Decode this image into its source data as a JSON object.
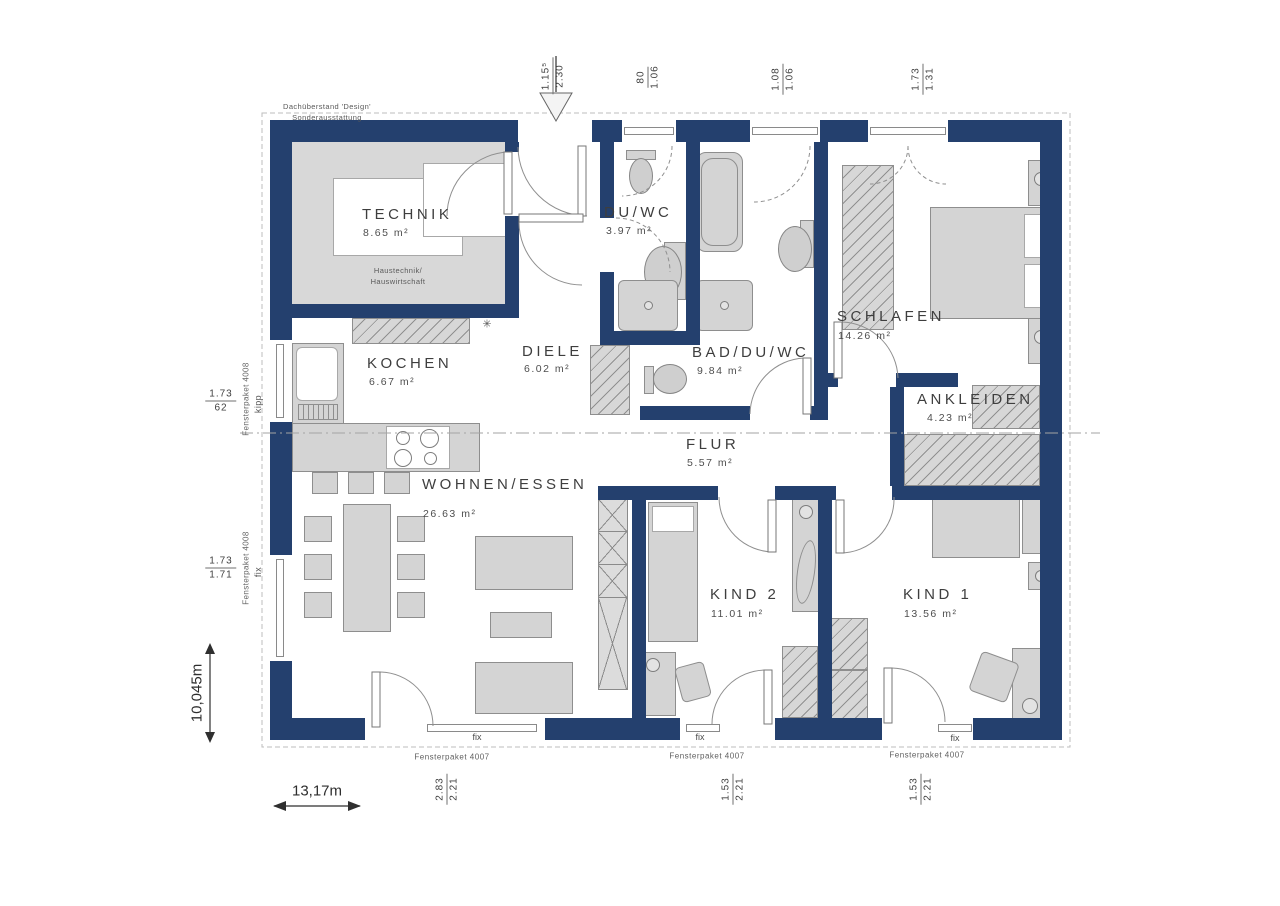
{
  "meta": {
    "roof_note_line1": "Dachüberstand 'Design'",
    "roof_note_line2": "Sonderausstattung"
  },
  "rooms": [
    {
      "name": "TECHNIK",
      "area": "8.65 m²",
      "note1": "Haustechnik/",
      "note2": "Hauswirtschaft"
    },
    {
      "name": "DU/WC",
      "area": "3.97 m²"
    },
    {
      "name": "BAD/DU/WC",
      "area": "9.84 m²"
    },
    {
      "name": "SCHLAFEN",
      "area": "14.26 m²"
    },
    {
      "name": "KOCHEN",
      "area": "6.67 m²"
    },
    {
      "name": "DIELE",
      "area": "6.02 m²"
    },
    {
      "name": "FLUR",
      "area": "5.57 m²"
    },
    {
      "name": "ANKLEIDEN",
      "area": "4.23 m²"
    },
    {
      "name": "WOHNEN/ESSEN",
      "area": "26.63 m²"
    },
    {
      "name": "KIND 2",
      "area": "11.01 m²"
    },
    {
      "name": "KIND 1",
      "area": "13.56 m²"
    }
  ],
  "dims_top": [
    {
      "num": "1.15⁵",
      "den": "2.30"
    },
    {
      "num": "80",
      "den": "1.06"
    },
    {
      "num": "1.08",
      "den": "1.06"
    },
    {
      "num": "1.73",
      "den": "1.31"
    }
  ],
  "dims_left": [
    {
      "num": "1.73",
      "den": "62",
      "package": "Fensterpaket 4008",
      "mode": "kipp"
    },
    {
      "num": "1.73",
      "den": "1.71",
      "package": "Fensterpaket 4008",
      "mode": "fix"
    }
  ],
  "dims_bottom": [
    {
      "num": "2.83",
      "den": "2.21",
      "package": "Fensterpaket 4007",
      "mode": "fix"
    },
    {
      "num": "1.53",
      "den": "2.21",
      "package": "Fensterpaket 4007",
      "mode": "fix"
    },
    {
      "num": "1.53",
      "den": "2.21",
      "package": "Fensterpaket 4007",
      "mode": "fix"
    }
  ],
  "overall_dims": {
    "width": "13,17m",
    "depth": "10,045m"
  },
  "symbols": {
    "freezer": "✳"
  },
  "colors": {
    "wall": "#24406e",
    "furniture": "#d4d4d4",
    "outline": "#8e8e8e",
    "text": "#3e3e3e"
  }
}
